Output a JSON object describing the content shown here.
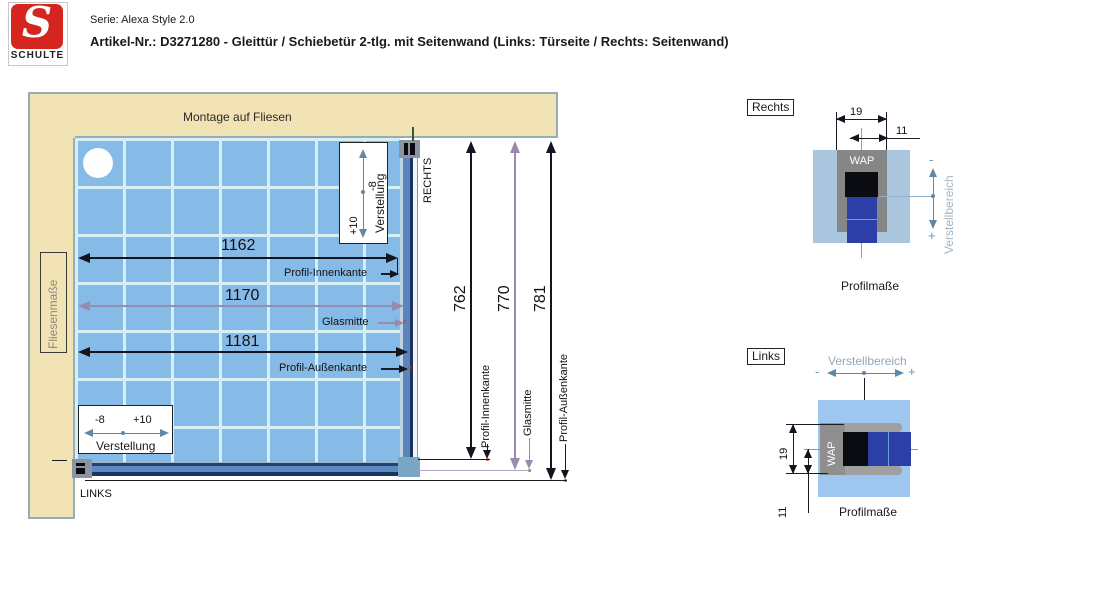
{
  "header": {
    "logo_letter": "S",
    "logo_text": "SCHULTE",
    "series_line": "Serie: Alexa Style 2.0",
    "article_line": "Artikel-Nr.: D3271280 - Gleittür / Schiebetür 2-tlg. mit Seitenwand  (Links: Türseite / Rechts: Seitenwand)"
  },
  "main_diagram": {
    "top_banner": "Montage auf Fliesen",
    "left_banner": "Fliesenmaße",
    "side_right": "RECHTS",
    "side_left": "LINKS",
    "width_dims": {
      "profil_innenkante": {
        "value": "1162",
        "label": "Profil-Innenkante"
      },
      "glasmitte": {
        "value": "1170",
        "label": "Glasmitte"
      },
      "profil_aussenkante": {
        "value": "1181",
        "label": "Profil-Außenkante"
      }
    },
    "height_dims": {
      "profil_innenkante": {
        "value": "762",
        "label": "Profil-Innenkante"
      },
      "glasmitte": {
        "value": "770",
        "label": "Glasmitte"
      },
      "profil_aussenkante": {
        "value": "781",
        "label": "Profil-Außenkante"
      }
    },
    "adjustment_box": {
      "minus": "-8",
      "plus": "+10",
      "label": "Verstellung"
    }
  },
  "detail_right": {
    "title": "Rechts",
    "profile_label": "WAP",
    "dim_19": "19",
    "dim_11": "11",
    "adjust_label": "Verstellbereich",
    "minus": "-",
    "plus": "+",
    "caption": "Profilmaße"
  },
  "detail_left": {
    "title": "Links",
    "profile_label": "WAP",
    "dim_19": "19",
    "dim_11": "11",
    "adjust_label": "Verstellbereich",
    "minus": "-",
    "plus": "+",
    "caption": "Profilmaße"
  },
  "colors": {
    "banner_beige": "#f1e3b3",
    "banner_border": "#96adb5",
    "tile_blue": "#87bbe7",
    "grout": "#d6eff4",
    "profile_steel": "#5b86bd",
    "profile_navy": "#1b335f",
    "bracket_gray": "#8a95a0",
    "dim_black": "#14141e",
    "dim_purple": "#998bb0",
    "adjust_steel": "#5e88a6",
    "detail_panel_right": "#a9c6de",
    "detail_panel_left": "#9fc6ee",
    "glass_blue": "#2b3fa6",
    "logo_red": "#d6251f",
    "marker_red": "#a85a52",
    "green_tick": "#2d5c36"
  }
}
